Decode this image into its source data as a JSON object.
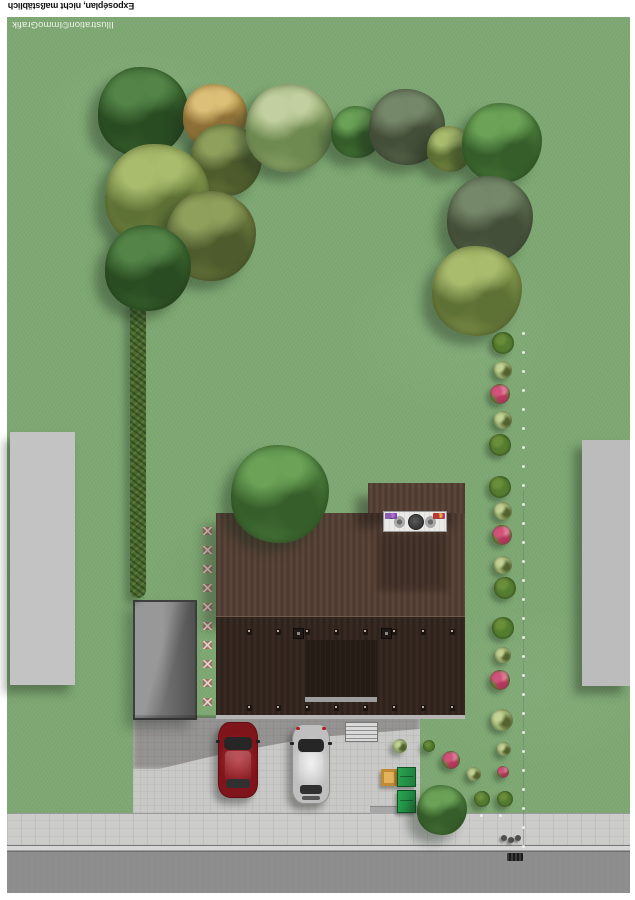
{
  "meta": {
    "title": "Exposéplan, nicht maßstäblich",
    "credit": "Illustration©ImmoGrafik",
    "orientation_note": "labels printed rotated 180 degrees"
  },
  "colors": {
    "grass": "#7ea873",
    "roof_upper": "#55423a",
    "roof_lower": "#32261f",
    "eave": "#b5b5b5",
    "terrace": "#e9e9e7",
    "driveway": "#c8c8c6",
    "sidewalk": "#cccccb",
    "curb": "#d6d6d6",
    "road": "#8d8d8d",
    "building_left": "#c3c3c3",
    "building_right": "#bcbcbc",
    "garage": "#8a8a8a",
    "stone": "#9c7163",
    "hedge": "#49692f",
    "bin": "#2aa452",
    "sandbox": "#e3b35c",
    "car_red": "#8f1d22",
    "car_silver": "#d9d9d9",
    "dot": "#f2f2ee",
    "flower_pink": "#d1537a"
  },
  "scene": {
    "trees": [
      {
        "x": 143,
        "y": 112,
        "r": 45,
        "kind": "dark"
      },
      {
        "x": 215,
        "y": 116,
        "r": 32,
        "kind": "golden"
      },
      {
        "x": 226,
        "y": 160,
        "r": 36,
        "kind": "olive"
      },
      {
        "x": 290,
        "y": 128,
        "r": 44,
        "kind": "pale"
      },
      {
        "x": 357,
        "y": 132,
        "r": 26,
        "kind": "green"
      },
      {
        "x": 407,
        "y": 127,
        "r": 38,
        "kind": "gray"
      },
      {
        "x": 450,
        "y": 149,
        "r": 23,
        "kind": "ygreen"
      },
      {
        "x": 502,
        "y": 143,
        "r": 40,
        "kind": "green"
      },
      {
        "x": 490,
        "y": 219,
        "r": 43,
        "kind": "gray"
      },
      {
        "x": 477,
        "y": 291,
        "r": 45,
        "kind": "ygreen"
      },
      {
        "x": 157,
        "y": 196,
        "r": 52,
        "kind": "ygreen"
      },
      {
        "x": 211,
        "y": 236,
        "r": 45,
        "kind": "olive"
      },
      {
        "x": 148,
        "y": 268,
        "r": 43,
        "kind": "dark"
      },
      {
        "x": 280,
        "y": 494,
        "r": 49,
        "kind": "green"
      },
      {
        "x": 442,
        "y": 810,
        "r": 25,
        "kind": "green"
      }
    ],
    "bushes": [
      {
        "x": 503,
        "y": 343,
        "r": 11,
        "kind": "dark"
      },
      {
        "x": 503,
        "y": 370,
        "r": 9,
        "kind": "light"
      },
      {
        "x": 500,
        "y": 394,
        "r": 10,
        "kind": "pink"
      },
      {
        "x": 503,
        "y": 420,
        "r": 9,
        "kind": "light"
      },
      {
        "x": 500,
        "y": 445,
        "r": 11,
        "kind": "dark"
      },
      {
        "x": 500,
        "y": 487,
        "r": 11,
        "kind": "dark"
      },
      {
        "x": 503,
        "y": 511,
        "r": 9,
        "kind": "light"
      },
      {
        "x": 502,
        "y": 535,
        "r": 10,
        "kind": "pink"
      },
      {
        "x": 503,
        "y": 565,
        "r": 9,
        "kind": "light"
      },
      {
        "x": 505,
        "y": 588,
        "r": 11,
        "kind": "dark"
      },
      {
        "x": 503,
        "y": 628,
        "r": 11,
        "kind": "dark"
      },
      {
        "x": 503,
        "y": 655,
        "r": 8,
        "kind": "light"
      },
      {
        "x": 500,
        "y": 680,
        "r": 10,
        "kind": "pink"
      },
      {
        "x": 502,
        "y": 720,
        "r": 11,
        "kind": "light"
      },
      {
        "x": 400,
        "y": 746,
        "r": 7,
        "kind": "light"
      },
      {
        "x": 429,
        "y": 746,
        "r": 6,
        "kind": "dark"
      },
      {
        "x": 504,
        "y": 749,
        "r": 7,
        "kind": "light"
      },
      {
        "x": 474,
        "y": 774,
        "r": 7,
        "kind": "light"
      },
      {
        "x": 451,
        "y": 760,
        "r": 9,
        "kind": "pink"
      },
      {
        "x": 503,
        "y": 772,
        "r": 6,
        "kind": "pink"
      },
      {
        "x": 482,
        "y": 799,
        "r": 8,
        "kind": "dark"
      },
      {
        "x": 505,
        "y": 799,
        "r": 8,
        "kind": "dark"
      }
    ],
    "stepping_stones": {
      "x": 203,
      "y_start": 527,
      "count": 10,
      "spacing": 19
    },
    "boundary": {
      "x": 522,
      "y_start": 332,
      "y_end": 845,
      "spacing": 19,
      "extra_dots": [
        [
          480,
          814
        ],
        [
          499,
          814
        ]
      ]
    },
    "roof_ticks": {
      "xs": [
        247,
        276,
        305,
        334,
        363,
        392,
        421,
        450
      ],
      "ys": [
        629,
        705
      ]
    },
    "bollards": [
      [
        501,
        835
      ],
      [
        508,
        837
      ],
      [
        515,
        835
      ]
    ]
  }
}
